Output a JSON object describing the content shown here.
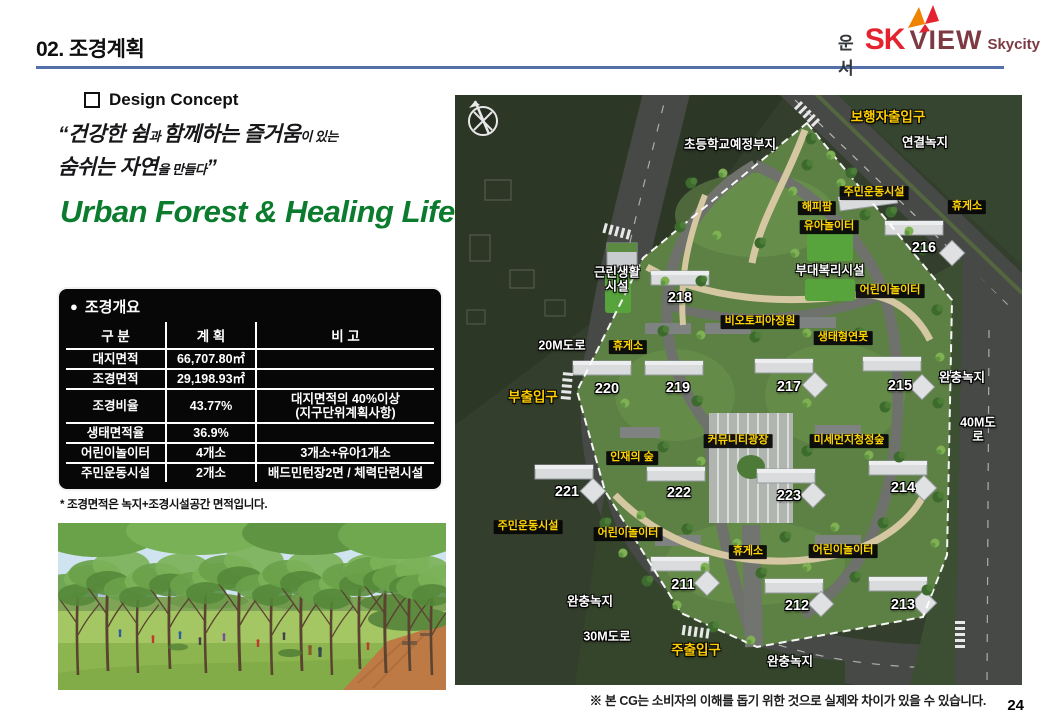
{
  "page": {
    "title": "02. 조경계획",
    "page_number": "24",
    "disclaimer": "※ 본 CG는 소비자의 이해를 돕기 위한 것으로 실제와 차이가 있을 수 있습니다."
  },
  "colors": {
    "header_rule_blue": "#5470a8",
    "slogan_green": "#0b7b2e",
    "map_label_yellow": "#ffd400",
    "logo_red": "#e4232f",
    "logo_maroon": "#7d3a42",
    "table_bg": "#070707"
  },
  "logo": {
    "prefix": "운서",
    "sk": "SK",
    "view": "VIEW",
    "suffix": "Skycity"
  },
  "design_concept": {
    "heading": "Design Concept",
    "quote_line1": [
      {
        "t": "“건강한 쉼",
        "b": 1
      },
      {
        "t": "과 ",
        "b": 0
      },
      {
        "t": "함께하는 즐거움",
        "b": 1
      },
      {
        "t": "이 있는",
        "b": 0
      }
    ],
    "quote_line2": [
      {
        "t": "숨쉬는 자연",
        "b": 1
      },
      {
        "t": "을 만들다",
        "b": 0
      },
      {
        "t": "”",
        "b": 1
      }
    ],
    "slogan": "Urban Forest & Healing Life"
  },
  "overview": {
    "bullet": "●",
    "title": "조경개요",
    "columns": [
      "구 분",
      "계 획",
      "비 고"
    ],
    "rows": [
      [
        "대지면적",
        "66,707.80㎡",
        ""
      ],
      [
        "조경면적",
        "29,198.93㎡",
        ""
      ],
      [
        "조경비율",
        "43.77%",
        "대지면적의 40%이상\n(지구단위계획사항)"
      ],
      [
        "생태면적율",
        "36.9%",
        ""
      ],
      [
        "어린이놀이터",
        "4개소",
        "3개소+유아1개소"
      ],
      [
        "주민운동시설",
        "2개소",
        "배드민턴장2면 / 체력단련시설"
      ]
    ],
    "footnote": "* 조경면적은 녹지+조경시설공간 면적입니다."
  },
  "site_plan": {
    "labels": [
      {
        "t": "초등학교예정부지",
        "x": 275,
        "y": 50,
        "k": "place"
      },
      {
        "t": "보행자출입구",
        "x": 433,
        "y": 23,
        "k": "ent"
      },
      {
        "t": "연결녹지",
        "x": 470,
        "y": 48,
        "k": "place"
      },
      {
        "t": "주민운동시설",
        "x": 419,
        "y": 98,
        "k": "box"
      },
      {
        "t": "해피팜",
        "x": 362,
        "y": 113,
        "k": "box"
      },
      {
        "t": "휴게소",
        "x": 512,
        "y": 112,
        "k": "box"
      },
      {
        "t": "유아놀이터",
        "x": 374,
        "y": 132,
        "k": "box"
      },
      {
        "t": "216",
        "x": 469,
        "y": 154,
        "k": "num"
      },
      {
        "t": "부대복리시설",
        "x": 375,
        "y": 176,
        "k": "place"
      },
      {
        "t": "근린생활\n시설",
        "x": 162,
        "y": 185,
        "k": "place"
      },
      {
        "t": "어린이놀이터",
        "x": 435,
        "y": 196,
        "k": "box"
      },
      {
        "t": "218",
        "x": 225,
        "y": 204,
        "k": "num"
      },
      {
        "t": "비오토피아정원",
        "x": 305,
        "y": 227,
        "k": "box"
      },
      {
        "t": "생태형연못",
        "x": 388,
        "y": 243,
        "k": "box"
      },
      {
        "t": "20M도로",
        "x": 107,
        "y": 251,
        "k": "place"
      },
      {
        "t": "휴게소",
        "x": 173,
        "y": 252,
        "k": "box"
      },
      {
        "t": "220",
        "x": 152,
        "y": 295,
        "k": "num"
      },
      {
        "t": "219",
        "x": 223,
        "y": 294,
        "k": "num"
      },
      {
        "t": "217",
        "x": 334,
        "y": 293,
        "k": "num"
      },
      {
        "t": "215",
        "x": 445,
        "y": 292,
        "k": "num"
      },
      {
        "t": "완충녹지",
        "x": 507,
        "y": 283,
        "k": "place"
      },
      {
        "t": "부출입구",
        "x": 78,
        "y": 303,
        "k": "ent"
      },
      {
        "t": "40M도로",
        "x": 523,
        "y": 335,
        "k": "place"
      },
      {
        "t": "커뮤니티광장",
        "x": 283,
        "y": 346,
        "k": "box"
      },
      {
        "t": "미세먼지청정숲",
        "x": 394,
        "y": 346,
        "k": "box"
      },
      {
        "t": "인재의 숲",
        "x": 177,
        "y": 363,
        "k": "box"
      },
      {
        "t": "221",
        "x": 112,
        "y": 398,
        "k": "num"
      },
      {
        "t": "222",
        "x": 224,
        "y": 399,
        "k": "num"
      },
      {
        "t": "223",
        "x": 334,
        "y": 402,
        "k": "num"
      },
      {
        "t": "214",
        "x": 448,
        "y": 394,
        "k": "num"
      },
      {
        "t": "주민운동시설",
        "x": 73,
        "y": 432,
        "k": "box"
      },
      {
        "t": "어린이놀이터",
        "x": 173,
        "y": 439,
        "k": "box"
      },
      {
        "t": "휴게소",
        "x": 293,
        "y": 457,
        "k": "box"
      },
      {
        "t": "어린이놀이터",
        "x": 388,
        "y": 456,
        "k": "box"
      },
      {
        "t": "211",
        "x": 228,
        "y": 491,
        "k": "num"
      },
      {
        "t": "완충녹지",
        "x": 135,
        "y": 507,
        "k": "place"
      },
      {
        "t": "212",
        "x": 342,
        "y": 512,
        "k": "num"
      },
      {
        "t": "213",
        "x": 448,
        "y": 511,
        "k": "num"
      },
      {
        "t": "30M도로",
        "x": 152,
        "y": 542,
        "k": "place"
      },
      {
        "t": "주출입구",
        "x": 241,
        "y": 556,
        "k": "ent"
      },
      {
        "t": "완충녹지",
        "x": 335,
        "y": 567,
        "k": "place"
      }
    ]
  }
}
